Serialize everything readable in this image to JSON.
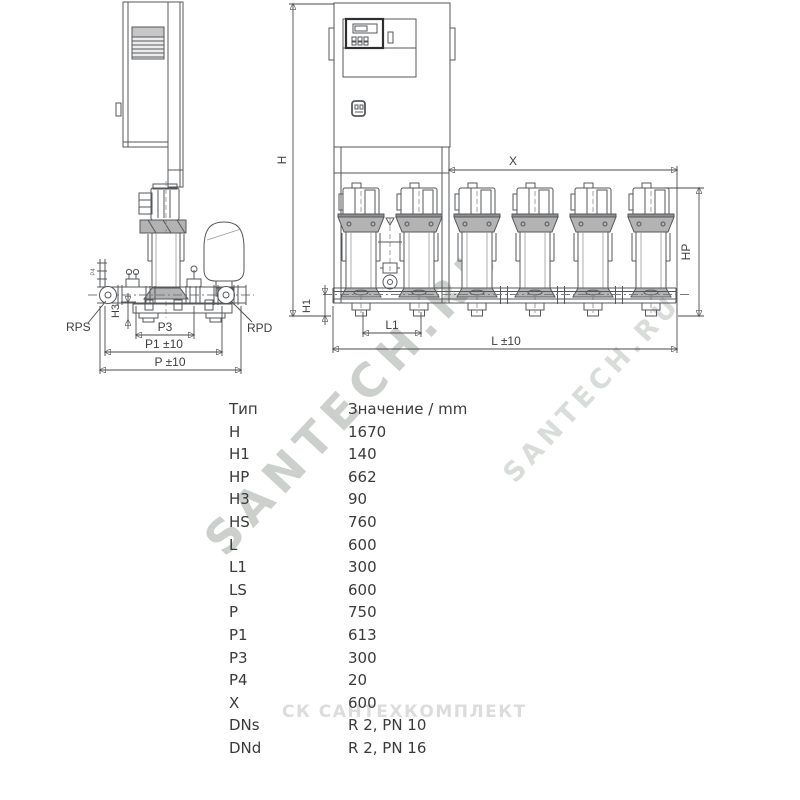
{
  "page": {
    "background": "#ffffff",
    "description": "Dimension drawing of multi-pump booster set with dimension table"
  },
  "colors": {
    "line": "#56575a",
    "dim_text": "#3d3d3f",
    "table_text": "#3a3a3a",
    "gray_fill": "#b3b3b3",
    "watermark_large": "#ccd0cc",
    "watermark_small": "#d9ddd9",
    "watermark_bottom": "#dcdcdc"
  },
  "dim_labels": {
    "h": "H",
    "h1": "H1",
    "hp": "HP",
    "x": "X",
    "l": "L ±10",
    "l1": "L1",
    "h3": "H3",
    "p3": "P3",
    "p1": "P1 ±10",
    "p": "P ±10",
    "p4": "P4",
    "rps": "RPS",
    "rpd": "RPD"
  },
  "watermarks": {
    "diagonal_large": "SANTECH.RU",
    "diagonal_small": "SANTECH.RU",
    "bottom": "СК САНТЕХКОМПЛЕКТ"
  },
  "table": {
    "headers": {
      "type": "Тип",
      "value": "Значение / mm"
    },
    "rows": [
      {
        "type": "H",
        "value": "1670"
      },
      {
        "type": "H1",
        "value": "140"
      },
      {
        "type": "HP",
        "value": "662"
      },
      {
        "type": "H3",
        "value": "90"
      },
      {
        "type": "HS",
        "value": "760"
      },
      {
        "type": "L",
        "value": "600"
      },
      {
        "type": "L1",
        "value": "300"
      },
      {
        "type": "LS",
        "value": "600"
      },
      {
        "type": "P",
        "value": "750"
      },
      {
        "type": "P1",
        "value": "613"
      },
      {
        "type": "P3",
        "value": "300"
      },
      {
        "type": "P4",
        "value": "20"
      },
      {
        "type": "X",
        "value": "600"
      },
      {
        "type": "DNs",
        "value": "R 2, PN 10"
      },
      {
        "type": "DNd",
        "value": "R 2, PN 16"
      }
    ]
  }
}
